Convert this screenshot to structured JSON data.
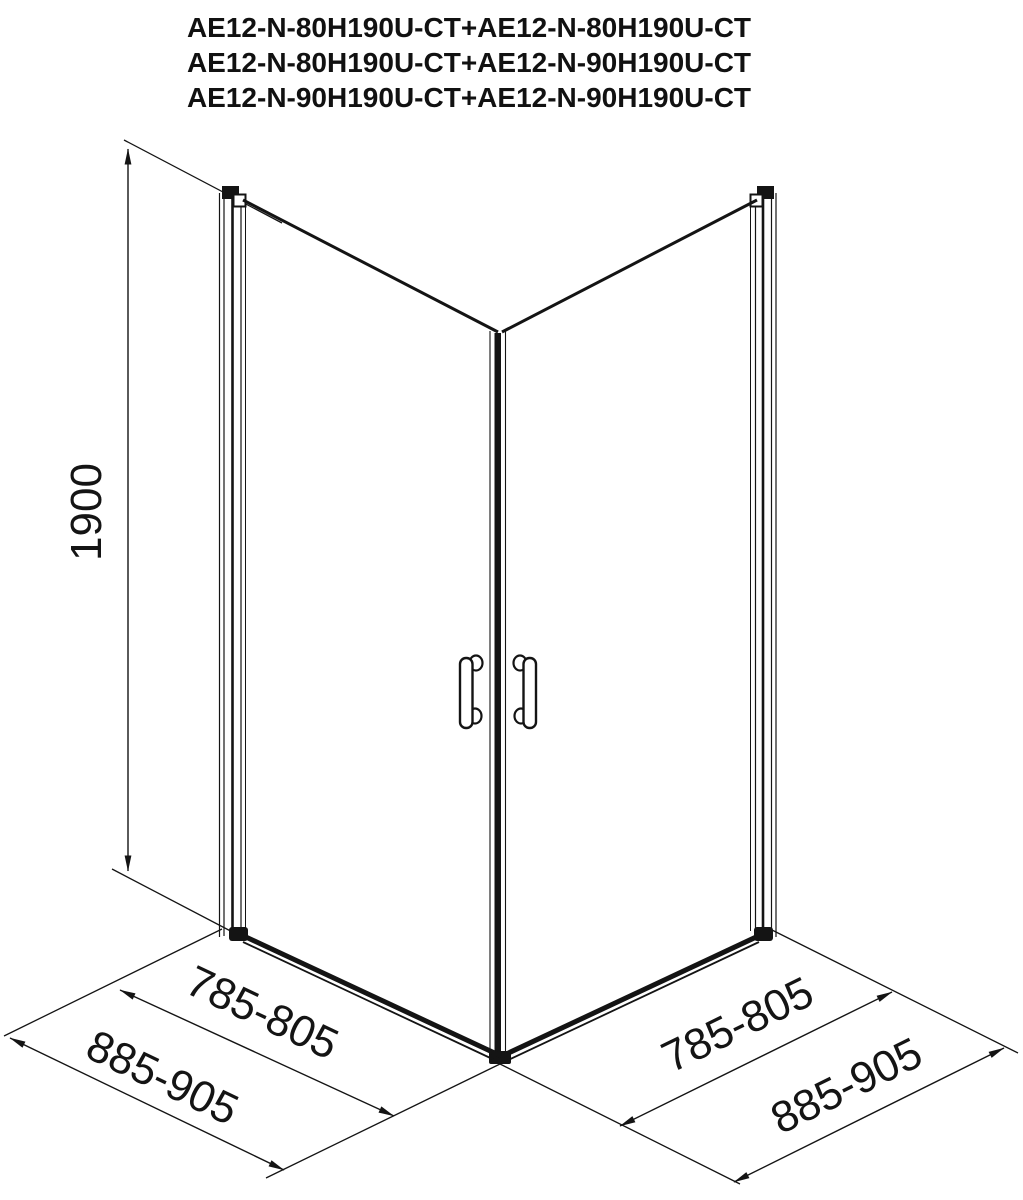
{
  "page": {
    "background": "#ffffff",
    "line_color": "#141414"
  },
  "title": {
    "lines": [
      "AE12-N-80H190U-CT+AE12-N-80H190U-CT",
      "AE12-N-80H190U-CT+AE12-N-90H190U-CT",
      "AE12-N-90H190U-CT+AE12-N-90H190U-CT"
    ]
  },
  "diagram": {
    "type": "technical-drawing",
    "dimensions": {
      "height": "1900",
      "left_door_width": "785-805",
      "left_overall_width": "885-905",
      "right_door_width": "785-805",
      "right_overall_width": "885-905"
    }
  }
}
